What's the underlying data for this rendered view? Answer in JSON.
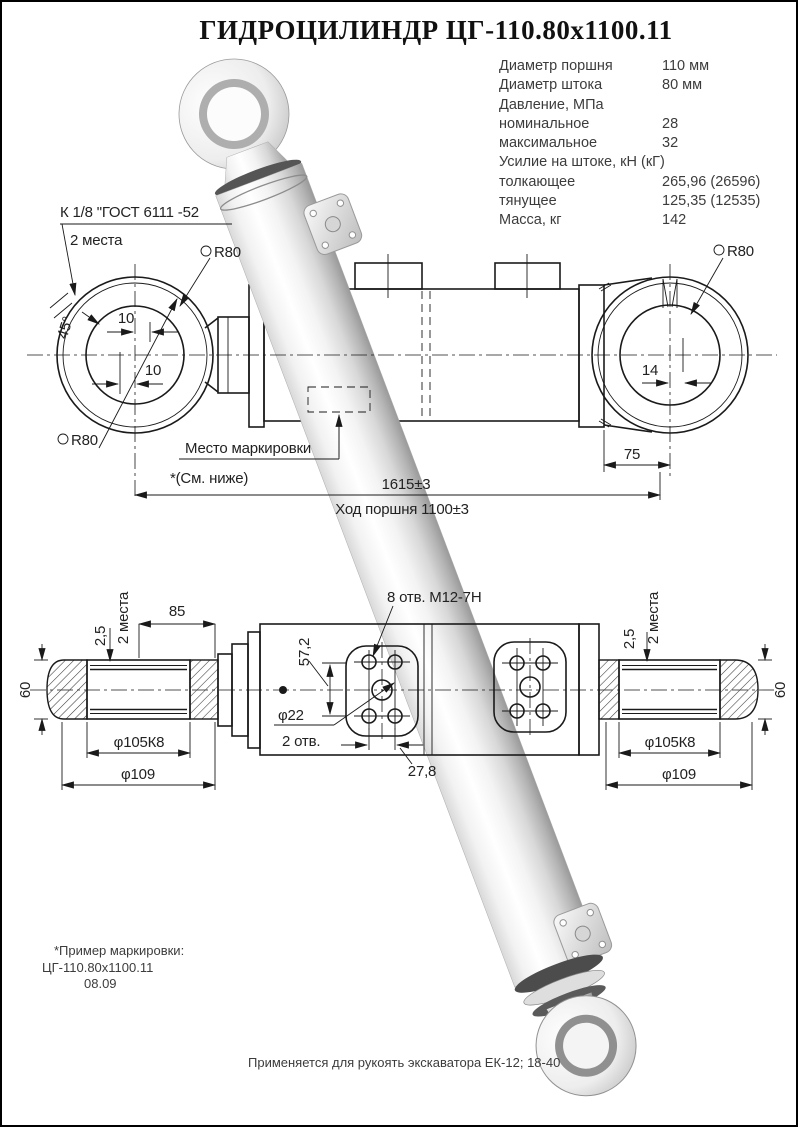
{
  "title": "ГИДРОЦИЛИНДР ЦГ-110.80х1100.11",
  "specs": {
    "rows": [
      {
        "label": "Диаметр поршня",
        "value": "110 мм"
      },
      {
        "label": "Диаметр штока",
        "value": "80 мм"
      },
      {
        "label": "Давление, МПа",
        "value": ""
      },
      {
        "label": "номинальное",
        "value": "28"
      },
      {
        "label": "максимальное",
        "value": "32"
      },
      {
        "label": "Усилие на штоке, кН (кГ)",
        "value": ""
      },
      {
        "label": "толкающее",
        "value": "265,96 (26596)"
      },
      {
        "label": "тянущее",
        "value": "125,35 (12535)"
      },
      {
        "label": "Масса, кг",
        "value": "142"
      }
    ]
  },
  "upper_view": {
    "port_note_line1": "К 1/8 \"ГОСТ 6111 -52",
    "port_note_line2": "2 места",
    "sphere_radius": "R80",
    "dim_offset_top": "10",
    "dim_offset_bottom": "10",
    "dim_angle": "45°",
    "marking_label": "Место маркировки",
    "see_below": "*(См. ниже)",
    "dim_overall": "1615±3",
    "dim_stroke": "Ход поршня 1100±3",
    "dim_right_offset": "14",
    "dim_pin_width": "75"
  },
  "lower_view": {
    "dim_85": "85",
    "dim_2_5": "2,5",
    "two_places": "2 места",
    "dim_60": "60",
    "dia_105": "φ105К8",
    "dia_109": "φ109",
    "holes_note": "8 отв. М12-7Н",
    "dim_57_2": "57,2",
    "dia_22": "φ22",
    "holes_2": "2 отв.",
    "dim_27_8": "27,8"
  },
  "footer": {
    "marking_example_label": "*Пример маркировки:",
    "marking_example_value": "ЦГ-110.80х1100.11",
    "marking_example_date": "08.09",
    "application_note": "Применяется для рукоять экскаватора ЕК-12; 18-40"
  },
  "colors": {
    "line": "#1a1a1a",
    "render_light": "#ffffff",
    "render_dark": "#999999",
    "background": "#ffffff"
  }
}
